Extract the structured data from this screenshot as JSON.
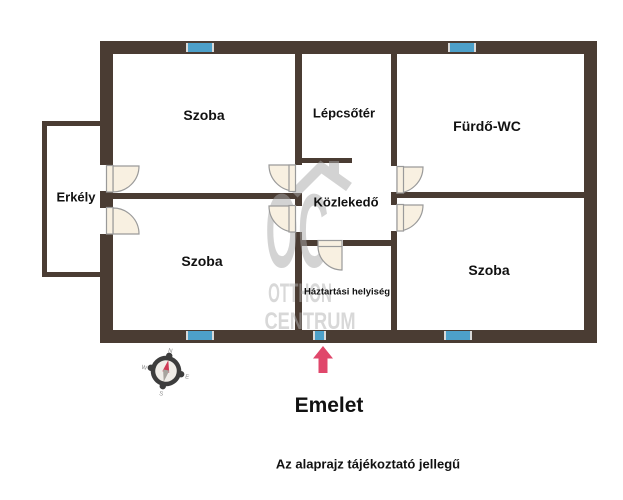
{
  "floorplan": {
    "rooms": {
      "szoba_top_left": "Szoba",
      "lepcsoter": "Lépcsőtér",
      "furdo_wc": "Fürdő-WC",
      "erkely": "Erkély",
      "kozlekedo": "Közlekedő",
      "szoba_bottom_left": "Szoba",
      "haztartasi_helyiseg": "Háztartási helyiség",
      "szoba_bottom_right": "Szoba"
    },
    "floor_title": "Emelet",
    "disclaimer": "Az alaprajz tájékoztató jellegű",
    "watermark": {
      "monogram": "OC",
      "line1": "OTTHON",
      "line2": "CENTRUM"
    },
    "compass": {
      "north": "N",
      "east": "E",
      "south": "S",
      "west": "W"
    },
    "colors": {
      "wall": "#4a3c33",
      "window_blue": "#4da0c9",
      "window_cap": "#d9d9d9",
      "door_fill": "#f8f0e1",
      "door_stroke": "#9a9a9a",
      "arrow_pink": "#e0476b",
      "compass_dark": "#3d3d3d",
      "compass_red": "#cf3a55",
      "compass_gray": "#a8a49e",
      "watermark_gray": "#a9a9a9",
      "text": "#111111"
    }
  }
}
